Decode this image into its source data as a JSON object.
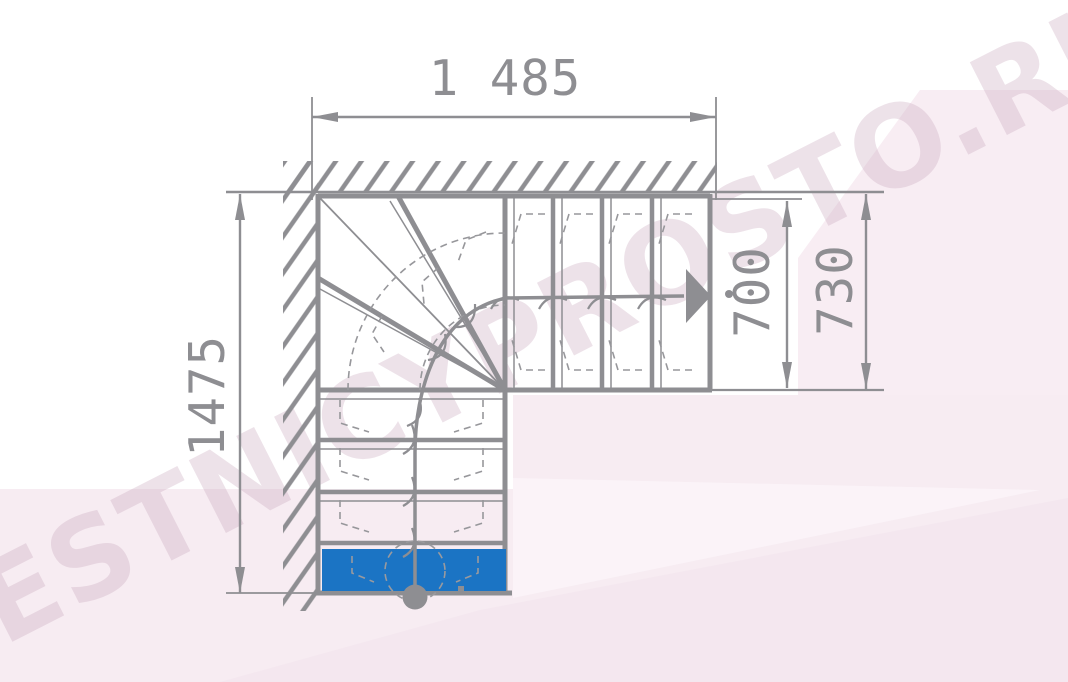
{
  "watermark": {
    "text": "LESTNICYPROSTO.RU"
  },
  "dimensions": {
    "top_width": "1 485",
    "left_height": "1475",
    "exit_flight_inner": "700",
    "exit_flight_outer": "730"
  },
  "colors": {
    "line": "#8e8e92",
    "first_step_highlight": "#1b74c4",
    "background_tint": "#f7ecf2",
    "watermark_tint": "#e9dce7"
  },
  "icons": {
    "walk_direction_arrow": "filled-right-triangle",
    "walk_start_marker": "filled-circle"
  }
}
